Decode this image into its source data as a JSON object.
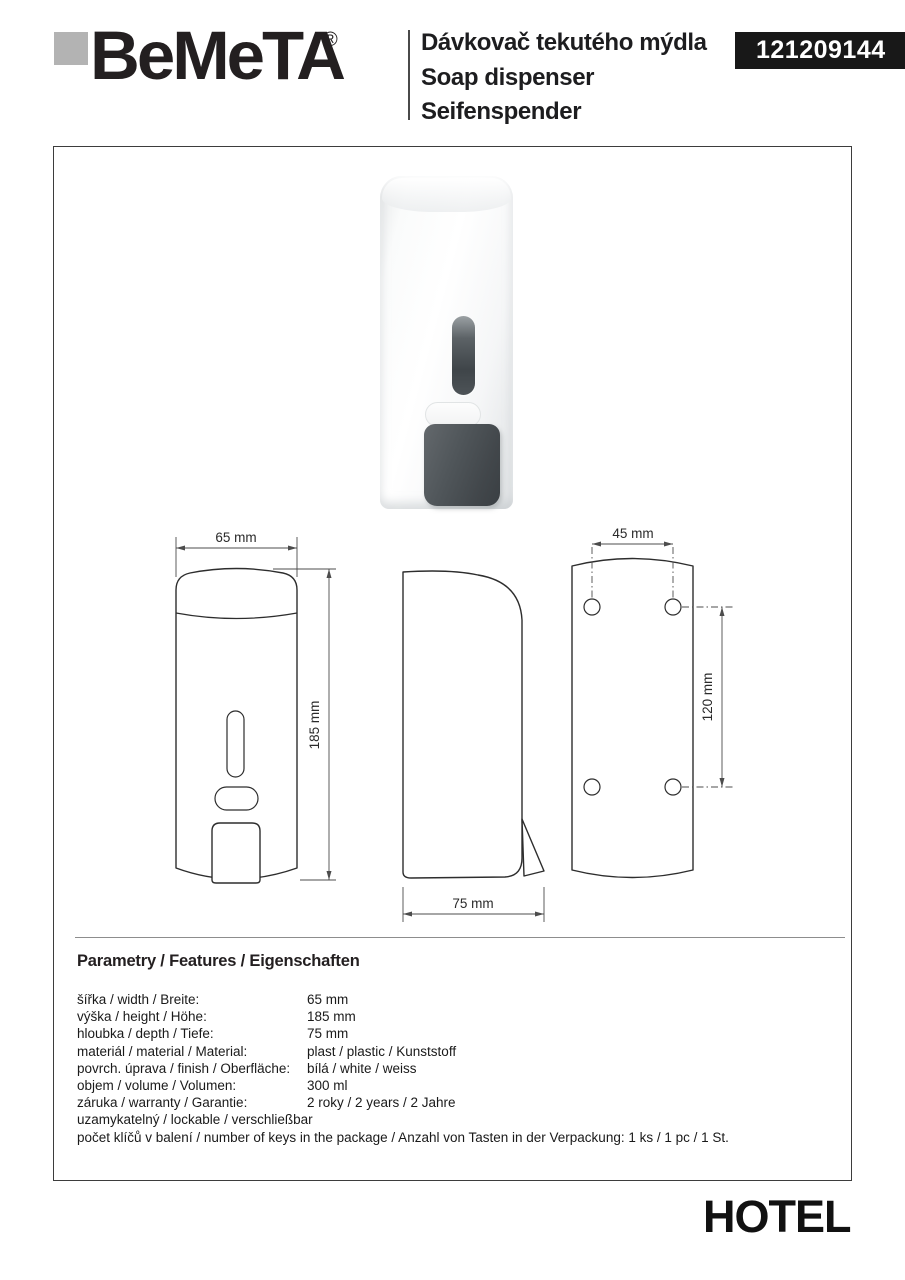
{
  "header": {
    "brand": "BeMeTA",
    "registered_mark": "®",
    "product_titles": [
      "Dávkovač tekutého mýdla",
      "Soap dispenser",
      "Seifenspender"
    ],
    "product_code": "121209144"
  },
  "drawings": {
    "front_width": "65 mm",
    "front_height": "185 mm",
    "side_depth": "75 mm",
    "back_hole_spacing_horizontal": "45 mm",
    "back_hole_spacing_vertical": "120 mm"
  },
  "parameters": {
    "heading": "Parametry / Features / Eigenschaften",
    "rows": [
      {
        "label": "šířka / width / Breite:",
        "value": "65 mm"
      },
      {
        "label": "výška / height / Höhe:",
        "value": "185 mm"
      },
      {
        "label": "hloubka / depth / Tiefe:",
        "value": "75 mm"
      },
      {
        "label": "materiál / material / Material:",
        "value": "plast / plastic / Kunststoff"
      },
      {
        "label": "povrch. úprava / finish / Oberfläche:",
        "value": "bílá / white / weiss"
      },
      {
        "label": "objem / volume / Volumen:",
        "value": "300 ml"
      },
      {
        "label": "záruka / warranty / Garantie:",
        "value": "2 roky / 2 years / 2 Jahre"
      },
      {
        "label": "uzamykatelný / lockable / verschließbar",
        "value": ""
      },
      {
        "label": "počet klíčů v balení / number of keys in the package / Anzahl von Tasten in der Verpackung: 1 ks / 1 pc / 1 St.",
        "value": ""
      }
    ]
  },
  "footer": {
    "series_name": "HOTEL"
  },
  "colors": {
    "badge_bg": "#181818",
    "text": "#231f20",
    "line_art": "#2d2d2d",
    "logo_square": "#b3b3b3"
  }
}
